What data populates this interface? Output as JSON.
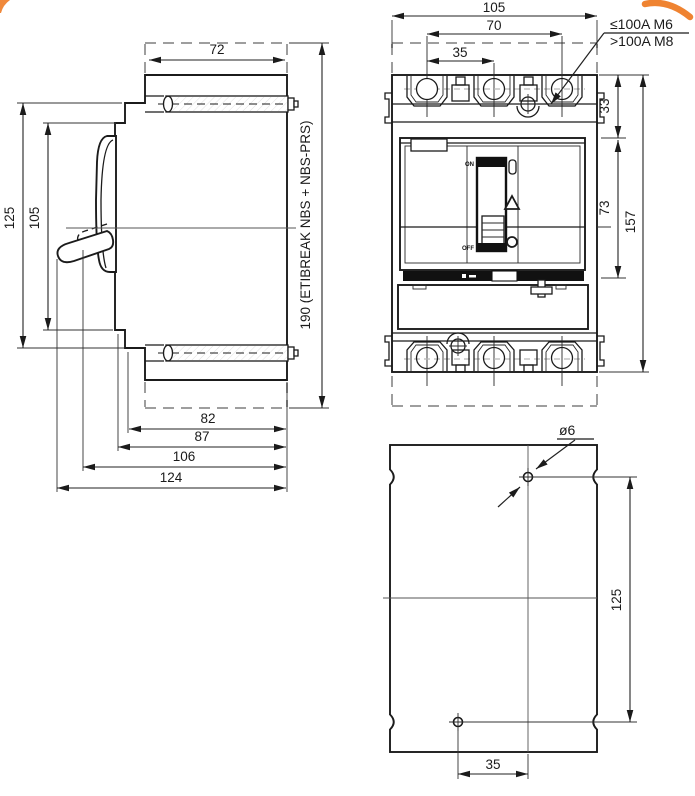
{
  "side_view": {
    "dim_top_width": "72",
    "dim_height_outer": "125",
    "dim_height_inner": "105",
    "dim_total_height": "190 (ETIBREAK NBS + NBS-PRS)",
    "dim_depth_body": "82",
    "dim_depth_face": "87",
    "dim_depth_handle_on": "106",
    "dim_depth_handle_off": "124"
  },
  "front_view": {
    "dim_width": "105",
    "dim_pole_span": "70",
    "dim_pole_pitch": "35",
    "dim_terminal_height": "33",
    "dim_cover_height": "73",
    "dim_total_height": "157",
    "terminal_note_line1": "≤100A M6",
    "terminal_note_line2": ">100A M8",
    "handle_on": "ON",
    "handle_off": "OFF"
  },
  "mounting_view": {
    "dim_hole_diameter": "ø6",
    "dim_hole_spacing": "125",
    "dim_hole_offset": "35"
  },
  "colors": {
    "line": "#1b1b1b",
    "dashed_gray": "#9e9e9e",
    "accent_orange": "#ee7c26"
  }
}
